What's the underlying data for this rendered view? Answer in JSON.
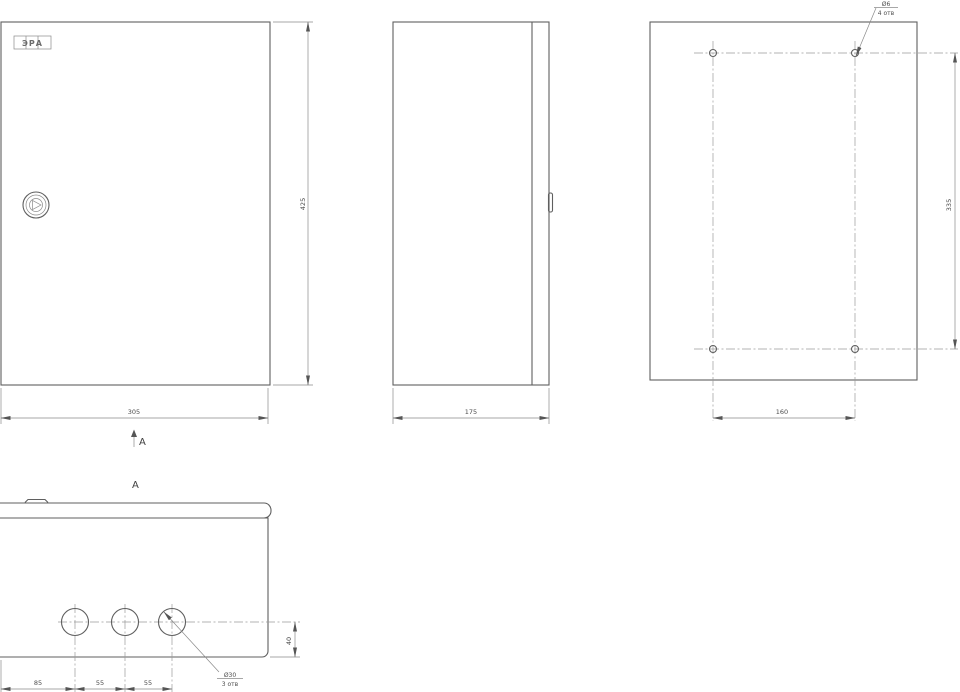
{
  "drawing": {
    "type": "engineering-orthographic-views",
    "background": "#ffffff",
    "line_color": "#5f5f5f",
    "dim_color": "#4d4d4d"
  },
  "logo": {
    "text": "ЭРА"
  },
  "front_view": {
    "width_dim": "305",
    "height_dim": "425",
    "view_arrow_label": "A"
  },
  "side_view": {
    "depth_dim": "175"
  },
  "back_view": {
    "holes_dia": "Ø6",
    "holes_qty": "4 отв",
    "spacing_horizontal": "160",
    "spacing_vertical": "335"
  },
  "bottom_view": {
    "title": "A",
    "holes_dia": "Ø30",
    "holes_qty": "3 отв",
    "edge_offset": "40",
    "spacings": [
      "85",
      "55",
      "55"
    ]
  }
}
